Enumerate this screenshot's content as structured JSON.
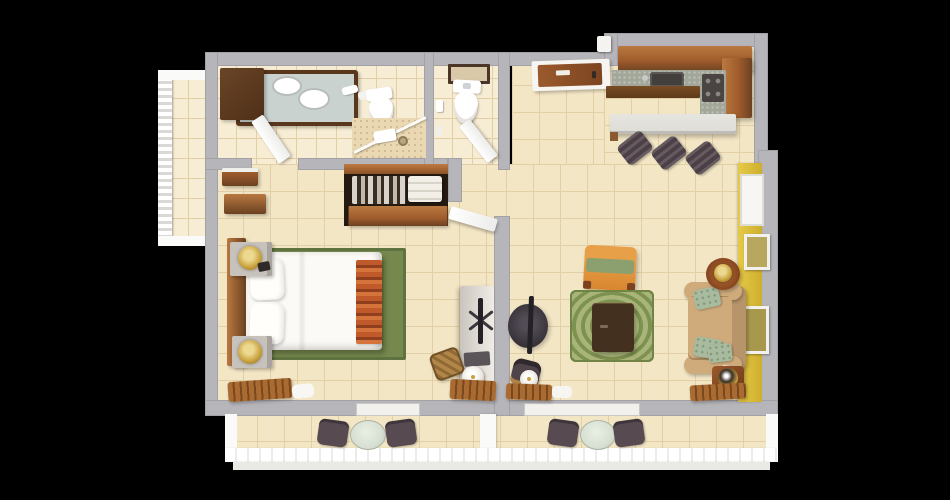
{
  "scene": {
    "type": "3d-floorplan-top-down-render",
    "background": "#000000",
    "visible_text": "none"
  },
  "palette": {
    "wall": "#b6b5b9",
    "wallEdge": "#a2a1a6",
    "floorTile": "#f3e6c5",
    "floorLine": "#e2cfa5",
    "bathTile": "#f7ecd4",
    "woodLight": "#b97940",
    "woodMid": "#a05c2c",
    "woodDark": "#6b4121",
    "woodFace": "#59371c",
    "vanityDark": "#4e3018",
    "railWhite": "#fafaf8",
    "offWhite": "#f2f1ed",
    "yellow": "#e5ca48",
    "yellowDeep": "#cfae2e",
    "rugGreen": "#76884e",
    "rugGreenDark": "#5f7340",
    "ringBase": "#a9b578",
    "ringDark": "#7d9150",
    "orange": "#d8862f",
    "orangeLight": "#e8a048",
    "chaiseGreen": "#8ba06e",
    "sofaTan": "#cfab7c",
    "sofaTanDark": "#b8946a",
    "pillowSage": "#a8bb9e",
    "sideTable": "#86441f",
    "coffeeTable": "#44301f",
    "tvDark": "#3a353b",
    "tvPanel": "#232026",
    "counter": "#a2a79a",
    "counterDark": "#433f3c",
    "barCounter": "#dddcd6",
    "stool": "#4c4046",
    "bistro": "#574b51",
    "glass": "#d7e0d2",
    "nightstand": "#c7c2bb",
    "gold": "#c9a23e",
    "goldLight": "#ecd88f",
    "bench": "#a96b31",
    "benchDark": "#7a481d",
    "shadow": "#00000040"
  },
  "floorplan": {
    "view": "top-down 3D architectural render of a one-bedroom suite",
    "rooms": [
      {
        "name": "master-bathroom",
        "contents": [
          "dark-wood double-sink vanity",
          "toilet",
          "glass corner shower",
          "white swing door",
          "wall towels"
        ]
      },
      {
        "name": "water-closet",
        "contents": [
          "toilet",
          "framed wall art",
          "paper holder",
          "white swing door"
        ]
      },
      {
        "name": "closet-hall",
        "contents": [
          "wardrobe with hanging clothes and linens",
          "wood lower cabinets",
          "two wall shelves",
          "white door to living room"
        ]
      },
      {
        "name": "bedroom",
        "contents": [
          "bed with white duvet and two pillows",
          "wood headboard",
          "orange striped bed runner",
          "green area rug",
          "two nightstands with gold lamps",
          "white console with swivel TV",
          "woven desk chair",
          "round lamp",
          "two slatted wood benches",
          "white cushion"
        ]
      },
      {
        "name": "entry",
        "contents": [
          "wood entry door with white casing",
          "wall thermostat"
        ]
      },
      {
        "name": "kitchen",
        "contents": [
          "L-shaped wood cabinets",
          "speckled counter",
          "cooktop",
          "corner range",
          "breakfast bar",
          "three bar stools"
        ]
      },
      {
        "name": "living-room",
        "contents": [
          "tan sofa with sage pillows",
          "orange chaise with green cushion",
          "round ringed green rug",
          "dark coffee table",
          "TV on round pedestal",
          "two wood side tables with lamps",
          "yellow accent wall",
          "white window recess",
          "two framed artworks",
          "dark chair",
          "white lamp",
          "slatted benches",
          "white cushion"
        ]
      },
      {
        "name": "side-balcony",
        "contents": [
          "white baluster railing",
          "tile floor"
        ]
      },
      {
        "name": "rear-balcony",
        "contents": [
          "two glass bistro tables",
          "four dark chairs",
          "white railing",
          "center divider",
          "two sliding-door openings"
        ]
      }
    ]
  }
}
